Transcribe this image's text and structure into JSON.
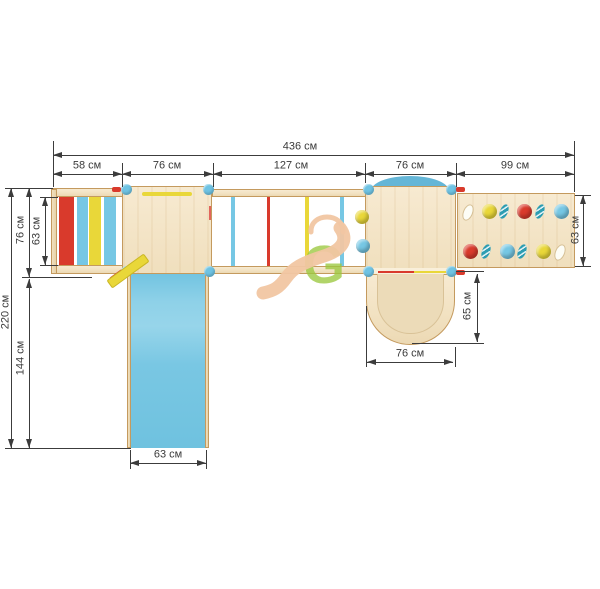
{
  "diagram": {
    "kind": "playground-set-top-view-drawing",
    "units": "см"
  },
  "dims": {
    "total": "436 см",
    "top": [
      "58 см",
      "76 см",
      "127 см",
      "76 см",
      "99 см"
    ],
    "left_total": "220 см",
    "left_upper": "76 см",
    "ladder_inner": "63 см",
    "left_lower": "144 см",
    "slide_width": "63 см",
    "tunnel_width": "76 см",
    "tunnel_depth": "65 см",
    "wall_depth": "63 см"
  },
  "watermark": {
    "letter": "G"
  },
  "palette": {
    "red": "#d93a2c",
    "yellow": "#e9d739",
    "blue": "#76c7e4",
    "teal": "#2d9db2",
    "hole_white": "#fdfdf6",
    "post_blue": "#6fc3e3",
    "dome_blue": "#64b6d7",
    "slide_blue": "#7cc9e4",
    "wood": "#f2e3c5",
    "wood_border": "#c49a5e",
    "tunnel_inner": "#ecdbb8",
    "entrance_strip": "#f9efda",
    "dim_line": "#3c3c3c",
    "watermark_peach": "#f1c6a2",
    "watermark_green": "#9cc83f"
  },
  "structure": {
    "ladder_rungs": [
      "red",
      "blue",
      "yellow",
      "blue"
    ],
    "bridge_rungs": [
      "blue",
      "red",
      "yellow",
      "blue"
    ],
    "platform2_left_holds": [
      "yellow",
      "blue"
    ],
    "wall_holds_top_row": [
      "hole",
      "yellow",
      "teal",
      "red",
      "teal",
      "blue"
    ],
    "wall_holds_bottom_row": [
      "red",
      "teal",
      "blue",
      "teal",
      "yellow",
      "hole"
    ]
  }
}
